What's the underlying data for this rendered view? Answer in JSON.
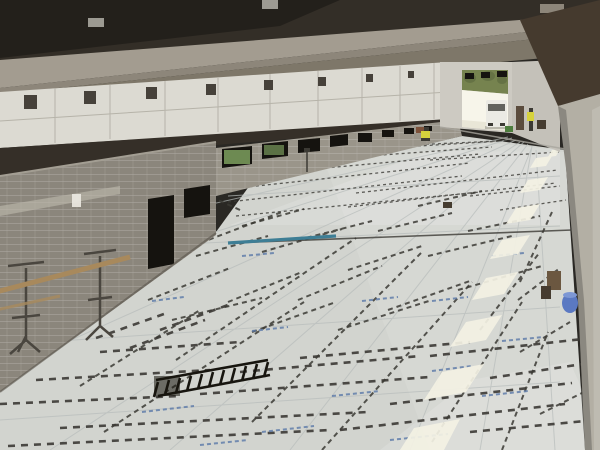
{
  "scene": {
    "type": "photograph",
    "description": "Elevated interior view of a large industrial hall under construction. Precast concrete ceiling beams converge toward a bright loading-door opening at the far end where a white van enters. The floor is covered with white insulation boards printed with blue text and marked with dark dashed layout lines for radiant tubing. Unfinished concrete-block rooms stand at the left; a massive concrete column frames the right edge. Sunlight patches fall across the right side of the floor.",
    "location_hint": "industrial hall / warehouse construction site",
    "lighting": "daylight from far doorway and right-side windows"
  },
  "objects": {
    "ceiling": "dark precast roof beams and grey concrete soffit",
    "panel_wall": "white clerestory wall panels with dark steel brackets",
    "block_room": "concrete masonry room with dark doorway and window opening",
    "low_block_wall": "receding low CMU wall with openings and green boards",
    "far_doorway": "open overhead-door bay with daylight and trees outside",
    "van": "white van entering through far doorway",
    "worker_by_door": "worker in yellow hi-vis vest near far door",
    "worker_crouching": "crouching worker in hi-vis at left wall",
    "insulated_floor": "white insulation boards with dashed tubing layout marks and blue print",
    "rebar_ladder": "black ladder-shaped reinforcement strip lying on floor",
    "trestles": "two metal trestle stands supporting a wooden scaffold plank",
    "teal_strip": "teal chalk-line strip on floor near block wall",
    "column": "large grey concrete column with dark capital, right foreground",
    "blue_barrel": "blue drum at column base",
    "equipment_boxes": "brown tool boxes beside column",
    "sun_patches": "row of bright window reflections on floor along right side"
  },
  "palette": {
    "ceiling_dark": "#332e27",
    "beam_light": "#a39c90",
    "beam_mid": "#8d867a",
    "soffit": "#7e7769",
    "fixture": "#9c9a92",
    "wall_panel": "#dcdad2",
    "panel_joint": "#b6b3a9",
    "bracket": "#46413a",
    "shadow_band": "#352f28",
    "cmu_wall": "#8b867c",
    "cmu_low_wall": "#9a958a",
    "cmu_top_light": "#a39e93",
    "opening_dark": "#15130f",
    "lintel": "#bcb7ab",
    "green_board": "#6d8a52",
    "paper_white": "#eceae2",
    "far_wall": "#cdcac2",
    "right_wall": "#c4c1b9",
    "daylight": "#f7f5ea",
    "tree_green": "#76834f",
    "tree_dark": "#5f6c40",
    "outside_ground": "#e6e3d4",
    "van_white": "#ebeae4",
    "van_glass": "#63635e",
    "vest_yellow": "#d6d23c",
    "worker_dark": "#3c3a34",
    "door_brown": "#5b4c3d",
    "column_brown": "#453a2e",
    "column_grey": "#b3afa4",
    "floor_base": "#d2d4cf",
    "sun_patch": "#f4f2e4",
    "dash_dark": "#3b3934",
    "seam": "#b7bcba",
    "blue_mark": "#5a78a8",
    "teal_strip": "#3e7e95",
    "wood_plank": "#a8895c",
    "metal": "#4a463f",
    "barrel_blue": "#5b79c2",
    "barrel_top": "#7d97d4",
    "ladder": "#17150f",
    "equip_brown": "#6b5740",
    "equip_dark": "#463c30",
    "green_machine": "#4e7e3e",
    "rust": "#7a4a32"
  }
}
